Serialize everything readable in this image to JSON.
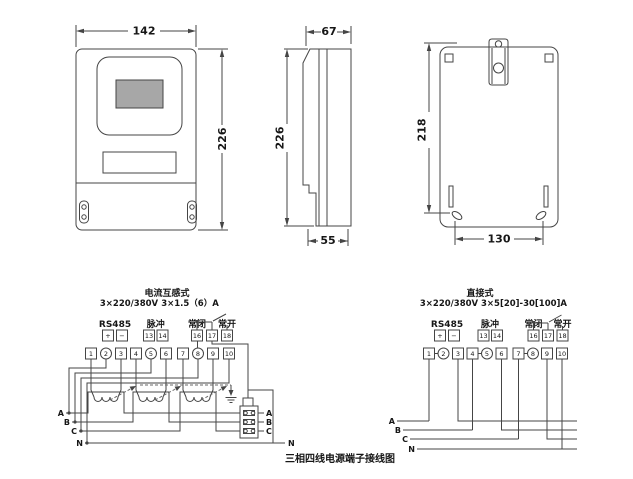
{
  "figure": {
    "caption": "三相四线电源端子接线图"
  },
  "dims": {
    "front_width": "142",
    "front_height": "226",
    "side_depth": "67",
    "side_height": "226",
    "side_base": "55",
    "back_height": "218",
    "back_hole_span": "130"
  },
  "ct_diagram": {
    "title": "电流互感式",
    "voltage": "3×220/380V",
    "current": "3×1.5（6）A",
    "rs485": "RS485",
    "pulse": "脉冲",
    "nc": "常闭",
    "no": "常开",
    "aux": [
      "+",
      "−",
      "13",
      "14",
      "16",
      "17",
      "18"
    ],
    "terminals": [
      "1",
      "2",
      "3",
      "4",
      "5",
      "6",
      "7",
      "8",
      "9",
      "10"
    ],
    "phase_in": [
      "A",
      "B",
      "C",
      "N"
    ],
    "fuse_out": [
      "A",
      "B",
      "C"
    ],
    "neutral_out": "N"
  },
  "direct_diagram": {
    "title": "直接式",
    "voltage": "3×220/380V",
    "current": "3×5[20]-30[100]A",
    "rs485": "RS485",
    "pulse": "脉冲",
    "nc": "常闭",
    "no": "常开",
    "aux": [
      "+",
      "−",
      "13",
      "14",
      "16",
      "17",
      "18"
    ],
    "terminals": [
      "1",
      "2",
      "3",
      "4",
      "5",
      "6",
      "7",
      "8",
      "9",
      "10"
    ],
    "phase_in": [
      "A",
      "B",
      "C",
      "N"
    ]
  }
}
